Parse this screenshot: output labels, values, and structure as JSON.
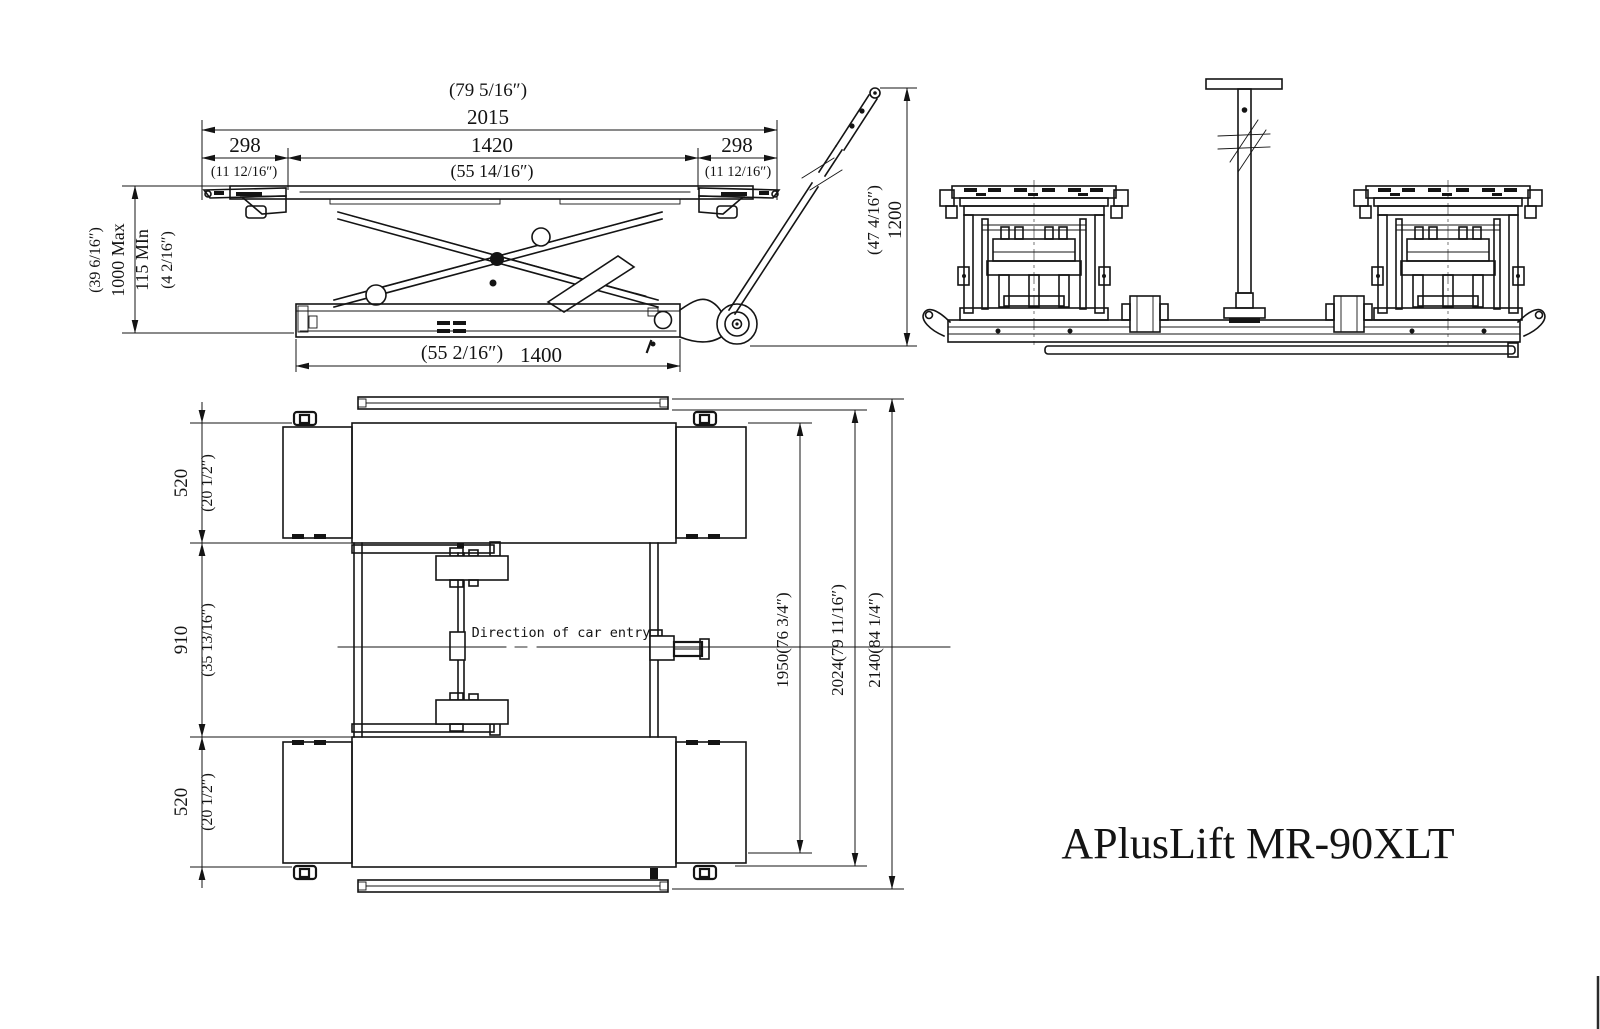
{
  "colors": {
    "background": "#ffffff",
    "ink": "#141414"
  },
  "title_block": {
    "model": "APlusLift MR-90XLT"
  },
  "side_view": {
    "dims": {
      "overall_in": "(79 5/16″)",
      "overall_mm": "2015",
      "left_end_mm": "298",
      "left_end_in": "(11 12/16″)",
      "between_mm": "1420",
      "between_in": "(55 14/16″)",
      "right_end_mm": "298",
      "right_end_in": "(11 12/16″)",
      "raise_in": "(39 6/16″)",
      "raise_max": "1000 Max",
      "raise_min": "115 MIn",
      "raise_min_in": "(4 2/16″)",
      "base_in": "(55 2/16″)",
      "base_mm": "1400",
      "handle_in": "(47 4/16″)",
      "handle_mm": "1200"
    }
  },
  "plan_view": {
    "direction_label": "Direction of car entry",
    "dims": {
      "top_ramp_mm": "520",
      "top_ramp_in": "(20 1/2″)",
      "center_mm": "910",
      "center_in": "(35 13/16″)",
      "bottom_ramp_mm": "520",
      "bottom_ramp_in": "(20 1/2″)",
      "length_inner": "1950(76 3/4″)",
      "length_mid": "2024(79 11/16″)",
      "length_overall": "2140(84 1/4″)"
    }
  }
}
